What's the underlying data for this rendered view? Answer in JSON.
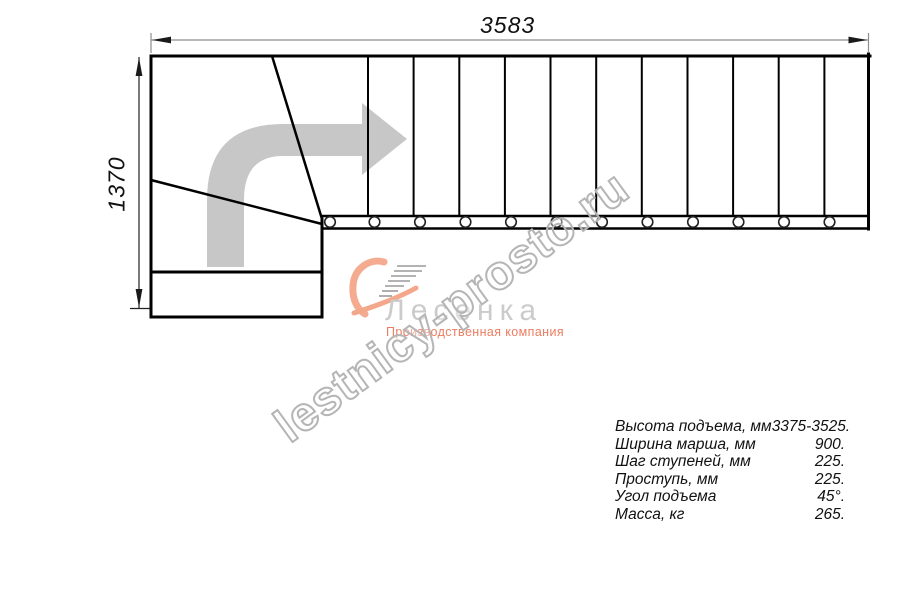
{
  "drawing": {
    "width_dimension": "3583",
    "height_dimension": "1370",
    "tread_count": 12,
    "baluster_count": 12,
    "arrow_color": "#c7c7c7",
    "line_color": "#000000",
    "dim_line_color": "#8e8e8e"
  },
  "watermark": {
    "text": "lestnicy-prosto.ru",
    "outline_color": "#b5b5b5"
  },
  "logo": {
    "name": "Лесенка",
    "tagline": "Производственная компания",
    "name_color": "#cbcbcb",
    "accent_color": "#f0a289"
  },
  "specs": {
    "rows": [
      {
        "label": "Высота подъема, мм",
        "value": "3375-3525."
      },
      {
        "label": "Ширина марша, мм",
        "value": "900."
      },
      {
        "label": "Шаг ступеней, мм",
        "value": "225."
      },
      {
        "label": "Проступь, мм",
        "value": "225."
      },
      {
        "label": "Угол подъема",
        "value": "45°."
      },
      {
        "label": "Масса, кг",
        "value": "265."
      }
    ]
  }
}
